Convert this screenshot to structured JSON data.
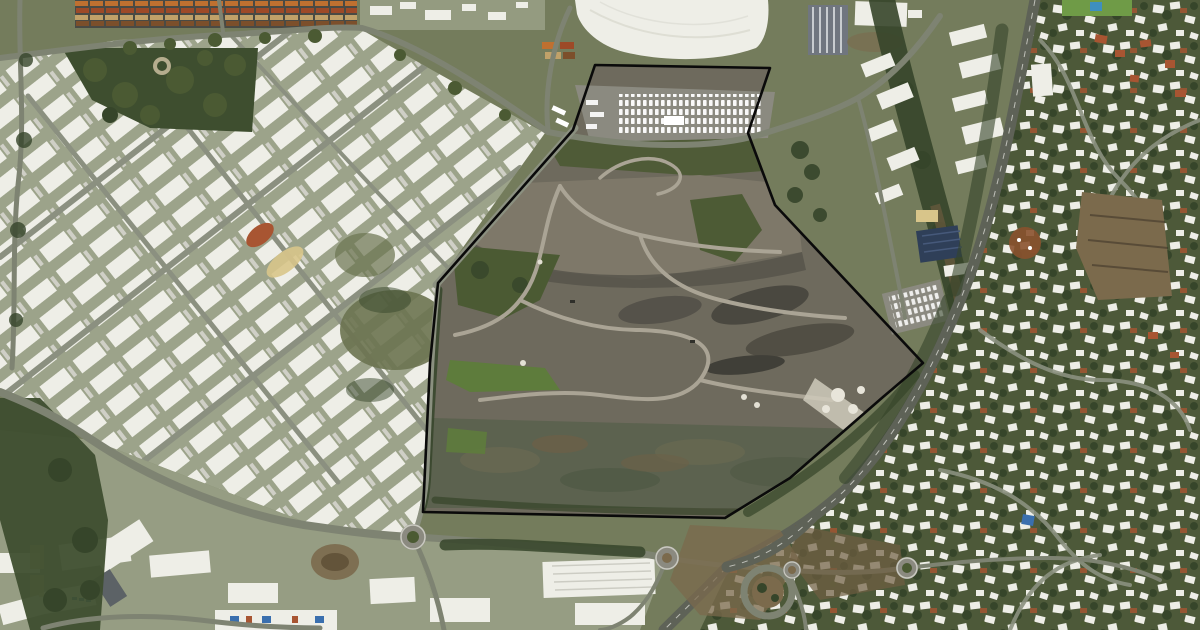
{
  "meta": {
    "kind": "aerial-satellite-photograph",
    "description": "Satellite view of an industrial coastal town: a large fenced quarry landfill site outlined in black at the center, container terminal and warehouse estate to the north-west, highway and hillside residential district to the east",
    "visible_text": ""
  },
  "boundary": {
    "name": "site-boundary-polygon",
    "points": "595,65 770,68 748,133 775,205 923,363 883,397 790,478 725,518 423,512 430,363 438,283 573,130",
    "color": "#0a0a0a",
    "stroke_width": 2.6
  },
  "landmarks": [
    "container-terminal",
    "industrial-estate-west",
    "city-park",
    "big-white-roof-building",
    "ribbed-tower-building",
    "vehicle-storage-parking",
    "quarry-landfill-site",
    "commercial-strip-east",
    "solar-roof-building",
    "highway",
    "interchange-loop",
    "roundabouts",
    "residential-hillside-east",
    "sports-field-with-pool",
    "bottom-warehouse-strip"
  ],
  "palette": {
    "bg": "#747c5c",
    "indGround": "#9ca38a",
    "roofWhite": "#eeeee7",
    "parkGreen": "#3e4e2f",
    "treeGreen": "#4b5a33",
    "treeDark": "#36452a",
    "quarry": "#6e6a5d",
    "quarryLight": "#7e7869",
    "quarryDark": "#55524a",
    "basin": "#5c624f",
    "brightGreen": "#5e7c3c",
    "scrub": "#6b7350",
    "dirtBrown": "#7b6a4c",
    "redDirt": "#8a512e",
    "resBase": "#4d5939",
    "asphalt": "#8b8a80",
    "solarBlue": "#2f3f58",
    "tanRoof": "#d8c58a",
    "fieldGreen": "#6f9b47",
    "poolBlue": "#3e8fc0",
    "ribbed": "#70767f",
    "containerOrange": "#bf7030",
    "containerRust": "#9d4a28",
    "containerTan": "#c0a169",
    "containerBrown": "#7c4f2b",
    "redRoof": "#a85532",
    "blueRoof": "#3a6fae",
    "road": "#7e8372",
    "roadLight": "#8b9080",
    "highway": "#5e6257",
    "trackLight": "#aaa495",
    "boundary": "#0a0a0a"
  }
}
